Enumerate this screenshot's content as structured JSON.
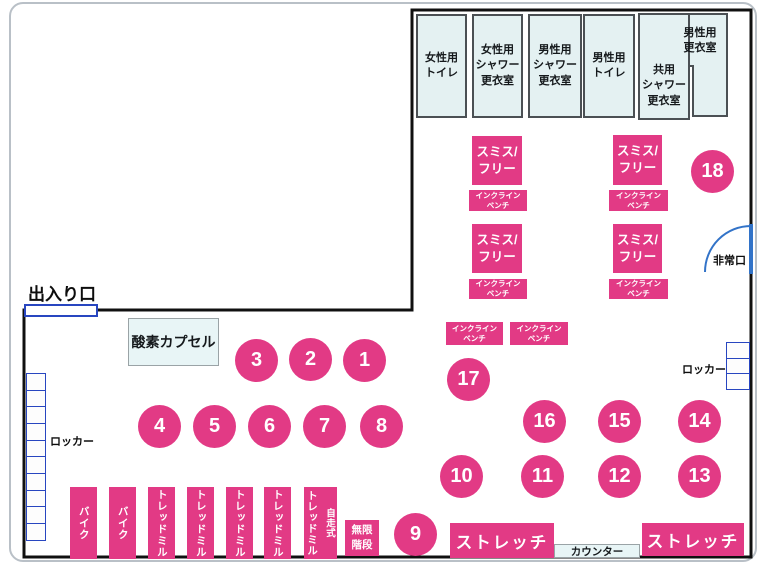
{
  "colors": {
    "pink": "#e23a85",
    "room_fill": "#e4f1f2",
    "room_border": "#4b5054",
    "locker_blue": "#2846c0",
    "emergency_arc_blue": "#3273c8",
    "wall": "#101010"
  },
  "rooms": [
    {
      "label": "女性用\nトイレ"
    },
    {
      "label": "女性用\nシャワー\n更衣室"
    },
    {
      "label": "男性用\nシャワー\n更衣室"
    },
    {
      "label": "男性用\nトイレ"
    },
    {
      "label": "共用\nシャワー\n更衣室"
    },
    {
      "label": "男性用\n更衣室"
    }
  ],
  "labels": {
    "entrance": "出入り口",
    "oxygen_capsule": "酸素カプセル",
    "locker": "ロッカー",
    "emergency_exit": "非常口",
    "counter": "カウンター",
    "infinite_stairs": "無限\n階段",
    "stretch": "ストレッチ",
    "smith_free": "スミス/\nフリー",
    "incline_bench": "インクライン\nベンチ"
  },
  "machines": {
    "bike": "バイク",
    "treadmill": "トレッドミル",
    "self_propelled": "自走式"
  },
  "circles": [
    "1",
    "2",
    "3",
    "4",
    "5",
    "6",
    "7",
    "8",
    "9",
    "10",
    "11",
    "12",
    "13",
    "14",
    "15",
    "16",
    "17",
    "18"
  ]
}
